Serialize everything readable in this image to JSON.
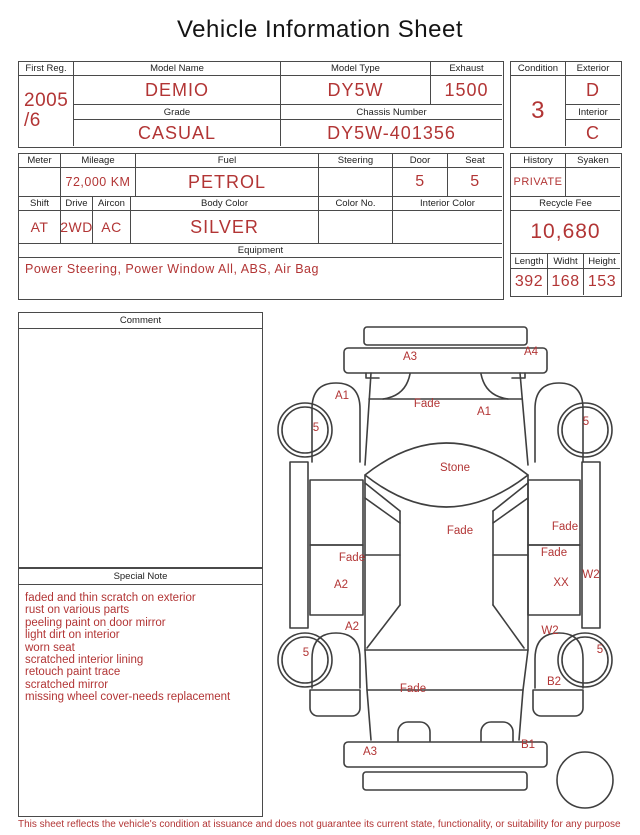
{
  "title": "Vehicle Information Sheet",
  "colors": {
    "red": "#b23535",
    "line": "#4a4a4a"
  },
  "table1": {
    "first_reg": {
      "label": "First Reg.",
      "value_line1": "2005",
      "value_line2": "/6"
    },
    "model_name": {
      "label": "Model Name",
      "value": "DEMIO"
    },
    "model_type": {
      "label": "Model Type",
      "value": "DY5W"
    },
    "exhaust": {
      "label": "Exhaust",
      "value": "1500"
    },
    "grade": {
      "label": "Grade",
      "value": "CASUAL"
    },
    "chassis_number": {
      "label": "Chassis Number",
      "value": "DY5W-401356"
    }
  },
  "condition_box": {
    "condition": {
      "label": "Condition",
      "value": "3"
    },
    "exterior": {
      "label": "Exterior",
      "value": "D"
    },
    "interior": {
      "label": "Interior",
      "value": "C"
    }
  },
  "table2": {
    "meter": {
      "label": "Meter",
      "value": ""
    },
    "mileage": {
      "label": "Mileage",
      "value": "72,000 KM"
    },
    "fuel": {
      "label": "Fuel",
      "value": "PETROL"
    },
    "steering": {
      "label": "Steering",
      "value": ""
    },
    "door": {
      "label": "Door",
      "value": "5"
    },
    "seat": {
      "label": "Seat",
      "value": "5"
    },
    "shift": {
      "label": "Shift",
      "value": "AT"
    },
    "drive": {
      "label": "Drive",
      "value": "2WD"
    },
    "aircon": {
      "label": "Aircon",
      "value": "AC"
    },
    "body_color": {
      "label": "Body Color",
      "value": "SILVER"
    },
    "color_no": {
      "label": "Color No.",
      "value": ""
    },
    "interior_color": {
      "label": "Interior Color",
      "value": ""
    },
    "equipment": {
      "label": "Equipment",
      "value": "Power Steering, Power Window  All, ABS, Air Bag"
    }
  },
  "right_block": {
    "history": {
      "label": "History",
      "value": "PRIVATE"
    },
    "syaken": {
      "label": "Syaken",
      "value": ""
    },
    "recycle_fee": {
      "label": "Recycle Fee",
      "value": "10,680"
    },
    "length": {
      "label": "Length",
      "value": "392"
    },
    "width": {
      "label": "Widht",
      "value": "168"
    },
    "height": {
      "label": "Height",
      "value": "153"
    }
  },
  "comment": {
    "label": "Comment",
    "value": ""
  },
  "special_note": {
    "label": "Special Note",
    "lines": [
      "faded and thin scratch on exterior",
      "rust on various parts",
      "peeling paint on door mirror",
      "light dirt on interior",
      "worn seat",
      "scratched interior lining",
      "retouch paint trace",
      "scratched mirror",
      "missing wheel cover-needs replacement"
    ]
  },
  "diagram": {
    "labels": [
      "A3",
      "A4",
      "A1",
      "Fade",
      "A1",
      "5",
      "5",
      "Stone",
      "Fade",
      "Fade",
      "Fade",
      "W2",
      "Fade",
      "A2",
      "XX",
      "A2",
      "W2",
      "5",
      "5",
      "B2",
      "Fade",
      "A3",
      "B1"
    ]
  },
  "footer": "This sheet reflects the vehicle's condition at issuance and does not guarantee its current state, functionality, or suitability for any purpose"
}
